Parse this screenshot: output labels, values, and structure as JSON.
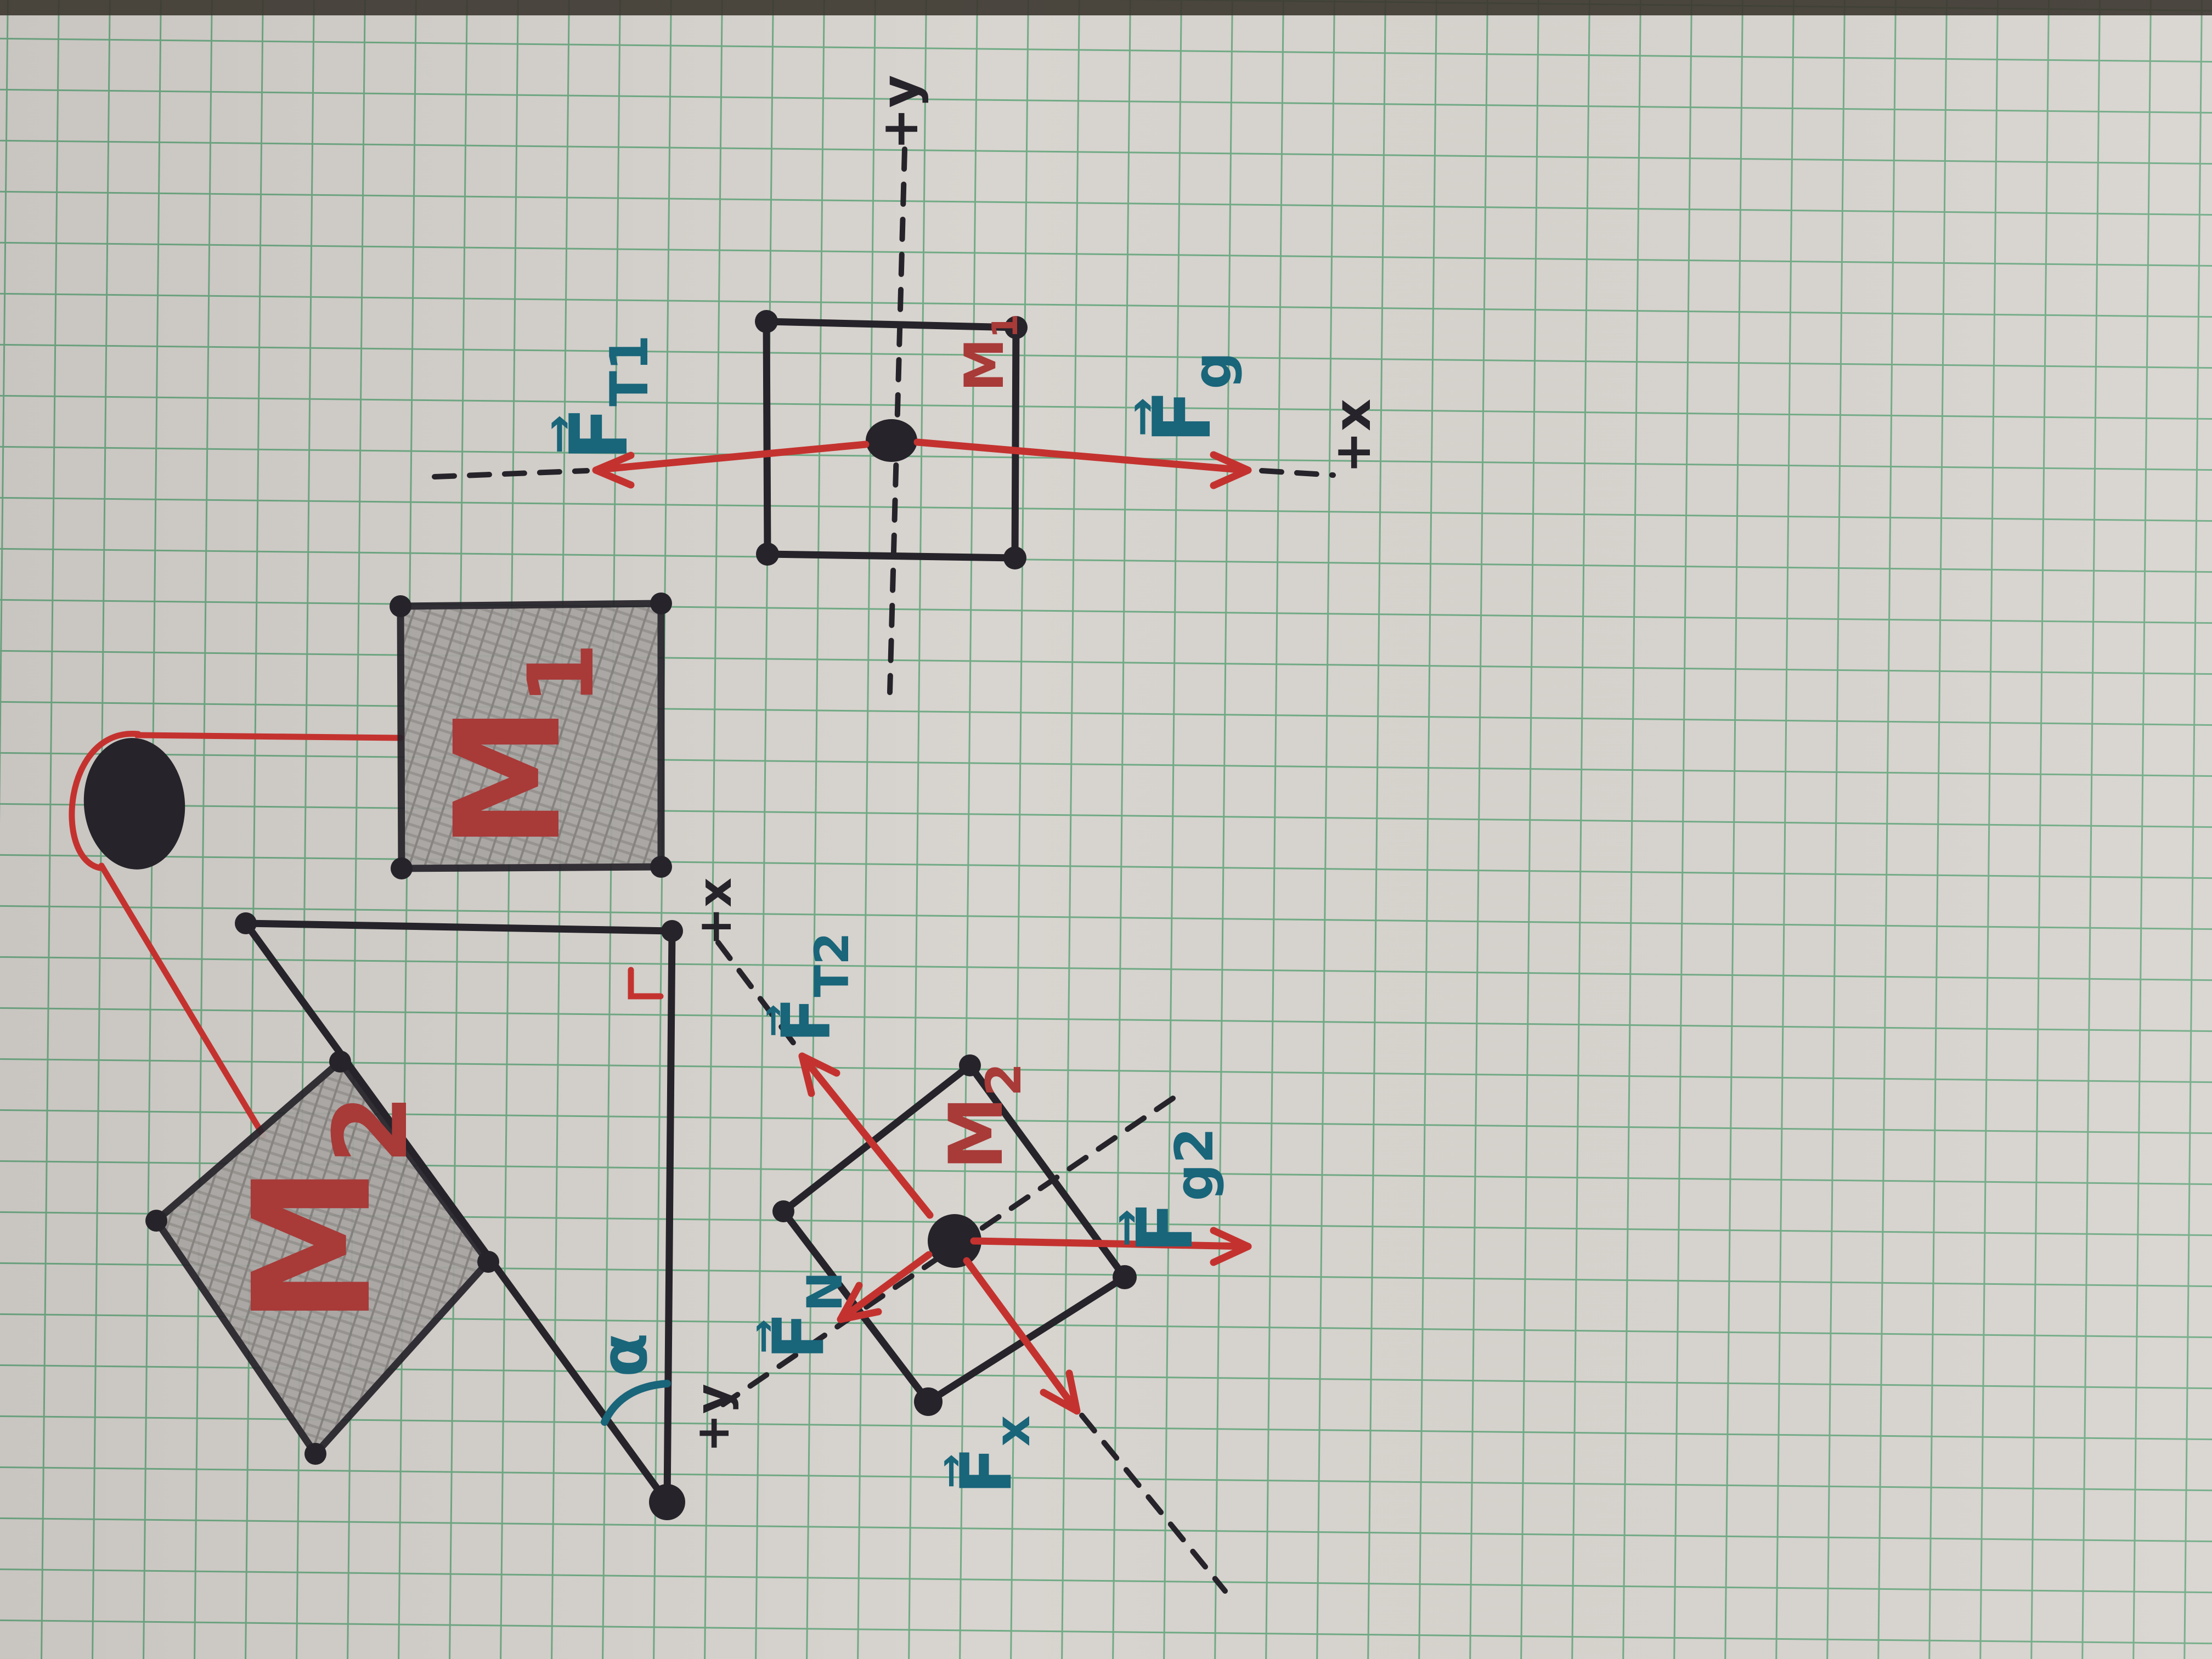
{
  "meta": {
    "kind": "hand-drawn physics free-body diagrams on green graph paper"
  },
  "colors": {
    "paper": "#d8d4cf",
    "grid_green": "#4f9e6d",
    "ink_black": "#26232a",
    "arrow_red": "#c4322f",
    "label_dark_red": "#a83a38",
    "label_teal": "#19657a",
    "pencil_gray": "#a8a5a2",
    "desk_edge": "#3b362f"
  },
  "fbd_top": {
    "axis_y": "+y",
    "axis_x": "+x",
    "mass": {
      "main": "M",
      "sub": "1"
    },
    "force_left": {
      "main": "F⃗",
      "sub": "T1"
    },
    "force_right": {
      "main": "F⃗",
      "sub": "g"
    }
  },
  "scene": {
    "mass_table": {
      "main": "M",
      "sub": "1"
    },
    "mass_incline": {
      "main": "M",
      "sub": "2"
    },
    "angle": "α"
  },
  "fbd_incline": {
    "axis_x": "+x",
    "axis_y": "+y",
    "mass": {
      "main": "M",
      "sub": "2"
    },
    "force_tension": {
      "main": "F⃗",
      "sub": "T2"
    },
    "force_gravity": {
      "main": "F⃗",
      "sub": "g2"
    },
    "force_normal": {
      "main": "F⃗",
      "sub": "N"
    },
    "force_gravity_x": {
      "main": "F⃗",
      "sub": "x"
    }
  }
}
